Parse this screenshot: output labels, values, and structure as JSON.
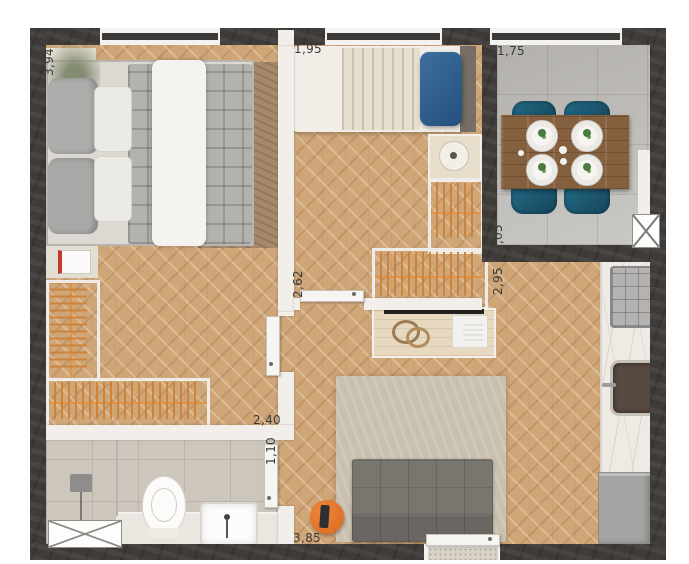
{
  "labels": {
    "bedroom1_length": "3,94",
    "bedroom2_width": "1,95",
    "dining_width": "1,75",
    "bedroom2_length": "2,62",
    "dining_length": "2,05",
    "living_length": "2,95",
    "bedroom1_width": "2,40",
    "bath_entry_width": "1,10",
    "living_width": "3,85"
  },
  "colors": {
    "wood_floor": "#cfa678",
    "tile_floor": "#c6c4c0",
    "bath_floor": "#cdc6bc",
    "wall_dark": "#3f3b38",
    "wall_light": "#f2efeb",
    "hanger_orange": "#cd8136",
    "accent_orange": "#e0732c",
    "chair_teal": "#1d5a72",
    "pillow_blue": "#2e5f8a",
    "sofa_gray": "#75716b",
    "counter_marble": "#efeae3"
  }
}
